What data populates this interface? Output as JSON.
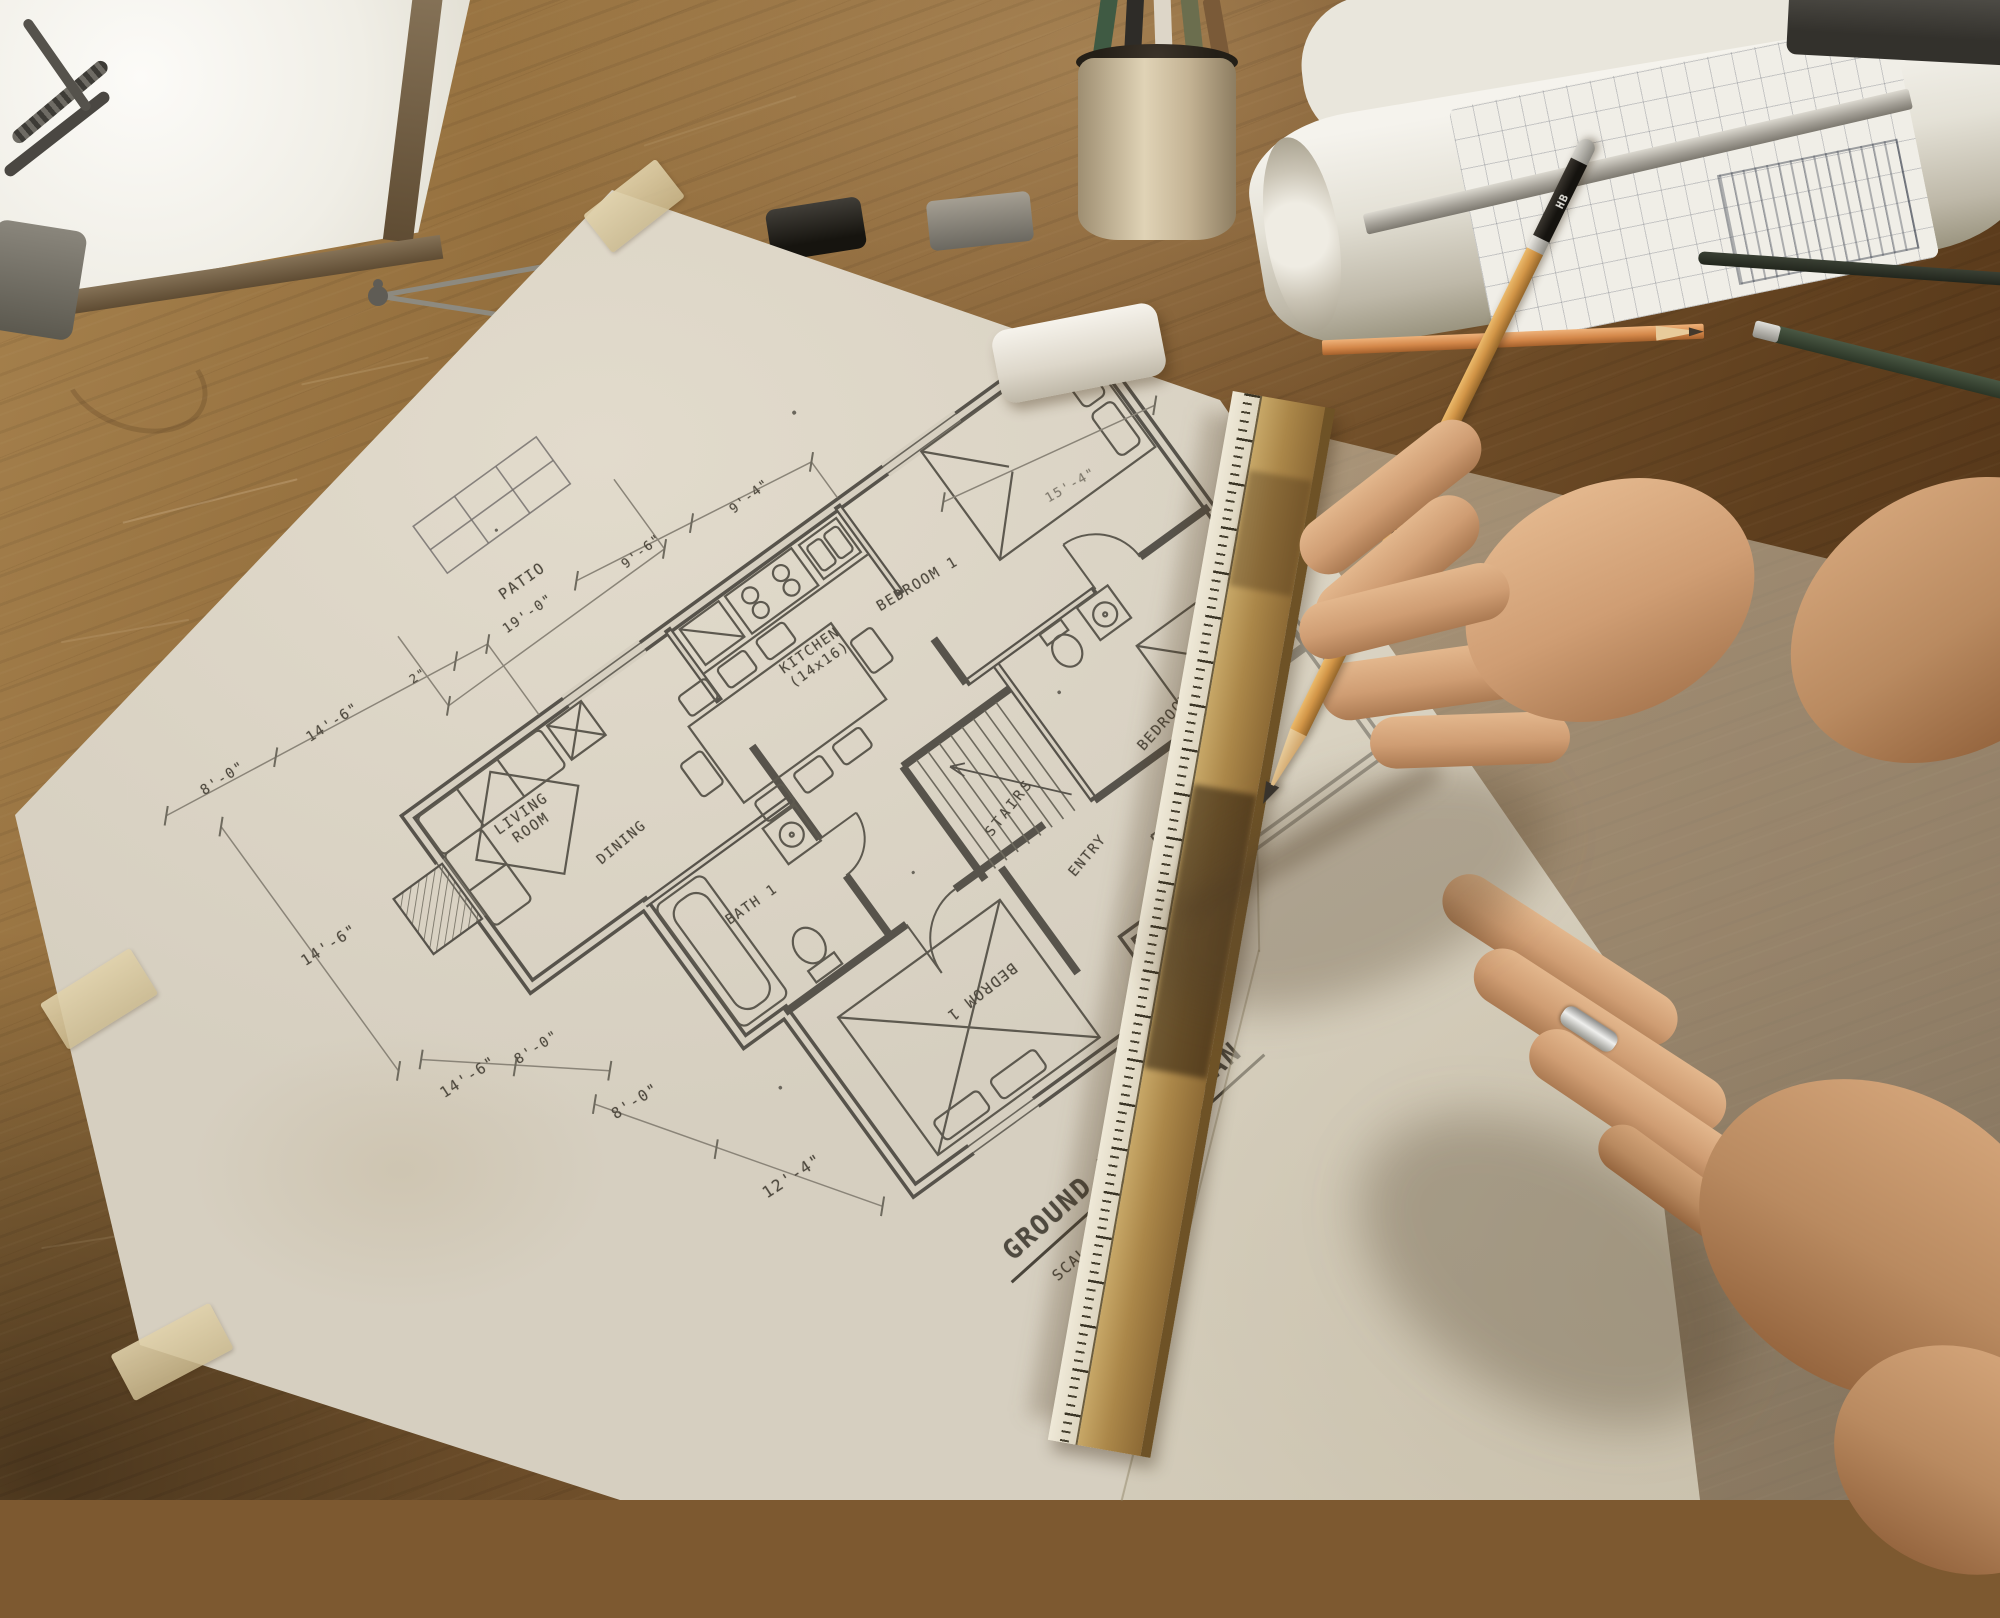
{
  "floorplan": {
    "title": "GROUND FLOOR PLAN",
    "scale": "SCALE: 1/4\"=1'-0\"",
    "rooms": {
      "bedroom_top": "BEDROOM 1",
      "bedroom_right": "BEDROOM 1",
      "bedroom_bottom": "BEDROM 1",
      "kitchen_line1": "KITCHEN",
      "kitchen_line2": "(14x16)",
      "living_line1": "LIVING",
      "living_line2": "ROOM",
      "dining": "DINING",
      "bath": "BATH 1",
      "stairs": "STAIRS",
      "entry": "ENTRY",
      "patio": "PATIO"
    },
    "dimensions": {
      "upper_left_1": "8'-0\"",
      "upper_left_2": "14'-6\"",
      "upper_left_3": "2\"",
      "patio_width": "19'-0\"",
      "top_mid_1": "9'-6\"",
      "top_mid_2": "9'-4\"",
      "top_right": "15'-4\"",
      "lower_outer": "14'-6\"",
      "lower_inner_1": "14'-6\"",
      "lower_inner_2": "8'-0\"",
      "bottom_1": "8'-0\"",
      "bottom_2": "12'-4\""
    }
  },
  "pencil": {
    "brand": "FABER-CASTELL",
    "grade": "HB"
  },
  "colors": {
    "paper": "#d6cfc0",
    "plan_ink": "#57534b",
    "desk_wood": "#7d5930",
    "ruler_wood": "#ab8749",
    "pencil_wood": "#d29547",
    "skin": "#cf9d73"
  }
}
